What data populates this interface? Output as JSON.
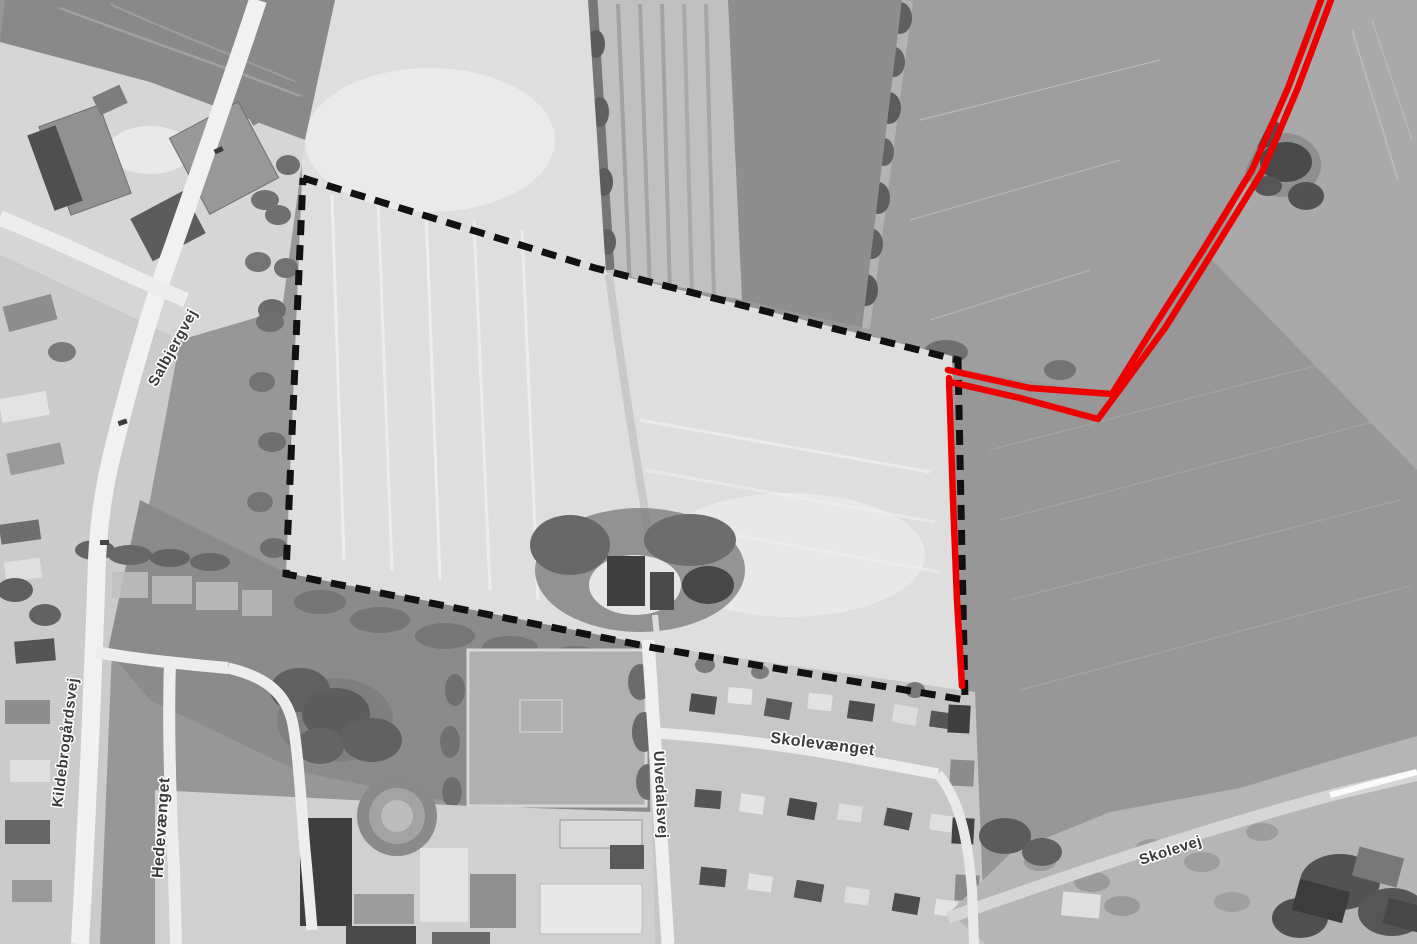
{
  "map": {
    "kind": "aerial-photo-plan",
    "description": "Grayscale orthophoto with plan boundary overlays",
    "road_labels": [
      {
        "id": "salbjergvej",
        "text": "Salbjergvej",
        "x": 177,
        "y": 350,
        "rotation": -61,
        "font_size": 15
      },
      {
        "id": "kildebrogardsvej",
        "text": "Kildebrogårdsvej",
        "x": 70,
        "y": 743,
        "rotation": -83,
        "font_size": 15
      },
      {
        "id": "hedevanget",
        "text": "Hedevænget",
        "x": 166,
        "y": 828,
        "rotation": -86,
        "font_size": 16
      },
      {
        "id": "ulvedalsvej",
        "text": "Ulvedalsvej",
        "x": 656,
        "y": 795,
        "rotation": 87,
        "font_size": 15
      },
      {
        "id": "skolevanget",
        "text": "Skolevænget",
        "x": 822,
        "y": 749,
        "rotation": 7,
        "font_size": 16
      },
      {
        "id": "skolevej",
        "text": "Skolevej",
        "x": 1172,
        "y": 855,
        "rotation": -18,
        "font_size": 15
      }
    ],
    "overlays": {
      "boundary": {
        "name": "site-boundary-dashed-line",
        "color": "#111111",
        "style": "dashed",
        "stroke_width": 7,
        "dash": "15 10",
        "points": [
          [
            303,
            178
          ],
          [
            595,
            268
          ],
          [
            958,
            360
          ],
          [
            965,
            700
          ],
          [
            655,
            648
          ],
          [
            286,
            574
          ],
          [
            303,
            178
          ]
        ]
      },
      "red_lines": {
        "name": "red-boundary-line",
        "color": "#ee0000",
        "stroke_width": 6.5,
        "paths": [
          [
            [
              1321,
              0
            ],
            [
              1288,
              88
            ],
            [
              1252,
              170
            ],
            [
              1203,
              250
            ],
            [
              1155,
              325
            ],
            [
              1112,
              394
            ],
            [
              1030,
              388
            ],
            [
              948,
              370
            ]
          ],
          [
            [
              1331,
              0
            ],
            [
              1297,
              90
            ],
            [
              1262,
              172
            ],
            [
              1212,
              253
            ],
            [
              1165,
              328
            ],
            [
              1098,
              419
            ],
            [
              1020,
              398
            ],
            [
              950,
              382
            ]
          ],
          [
            [
              949,
              378
            ],
            [
              953,
              500
            ],
            [
              957,
              600
            ],
            [
              962,
              686
            ]
          ]
        ]
      }
    }
  }
}
